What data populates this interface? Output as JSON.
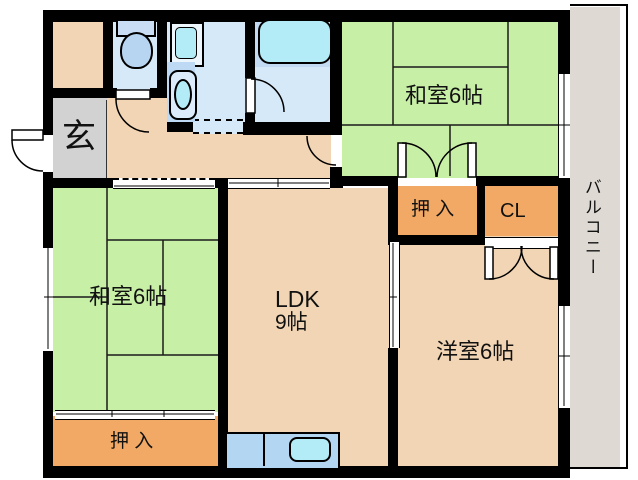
{
  "floorplan": {
    "labels": {
      "genkan": "玄",
      "washitsu_top_right": "和室6帖",
      "washitsu_left": "和室6帖",
      "ldk_name": "LDK",
      "ldk_size": "9帖",
      "western_room": "洋室6帖",
      "oshiire_top": "押 入",
      "oshiire_bottom": "押 入",
      "closet": "CL",
      "balcony": "バルコニー"
    },
    "colors": {
      "tatami_green": "#c8efa6",
      "flooring_tan": "#f2d5b4",
      "closet_orange": "#f1a965",
      "genkan_gray": "#d2d2d2",
      "wet_area_blue": "#d6e9f8",
      "bath_zone_blue": "#c3dcf4",
      "fixture_cyan": "#b3ecf6",
      "kitchen_counter_blue": "#b3d7f2",
      "balcony_gray": "#ded9d2",
      "wall_black": "#000000"
    }
  }
}
